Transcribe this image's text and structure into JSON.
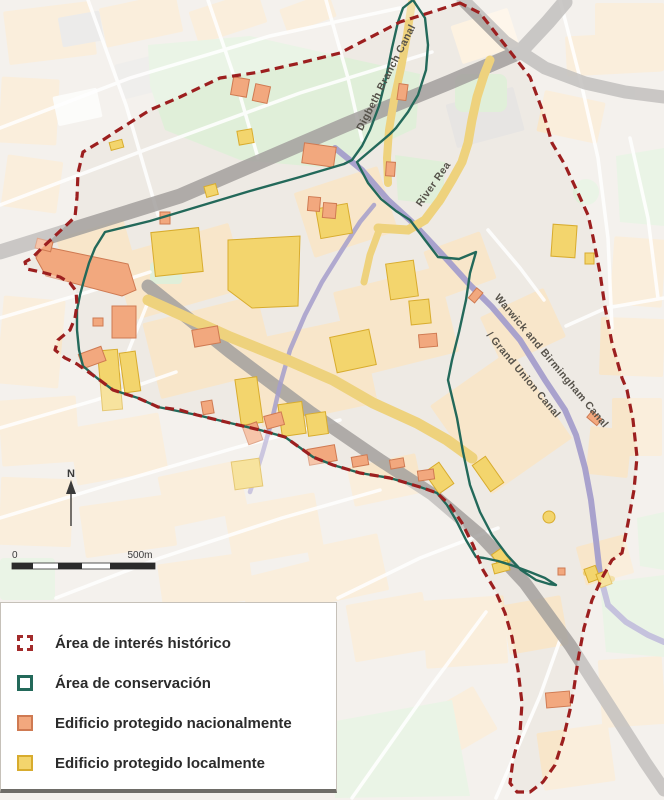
{
  "map": {
    "labels": {
      "digbeth_canal": "Digbeth Branch Canal",
      "river_rea": "River Rea",
      "warwick_canal": "Warwick and Birmingham Canal",
      "grand_union": "/ Grand Union Canal"
    },
    "north_label": "N",
    "scale": {
      "start": "0",
      "end": "500m"
    }
  },
  "legend": {
    "items": [
      {
        "label": "Área de interés histórico",
        "swatch": "dashed-outline",
        "color": "#a32b2b"
      },
      {
        "label": "Área de conservación",
        "swatch": "solid-outline",
        "color": "#23695a"
      },
      {
        "label": "Edificio protegido nacionalmente",
        "swatch": "fill",
        "color": "#f2a87e",
        "border": "#cf7a52"
      },
      {
        "label": "Edificio protegido localmente",
        "swatch": "fill",
        "color": "#f3d56d",
        "border": "#d8ac2e"
      }
    ]
  },
  "colors": {
    "historic_boundary": "#9c1f1f",
    "conservation_boundary": "#23695a",
    "national_building_fill": "#f2a87e",
    "national_building_border": "#cf7a52",
    "local_building_fill": "#f3d56d",
    "local_building_border": "#d8ac2e",
    "railway": "#a3a09e",
    "canal": "#a49ecb",
    "main_road": "#eed27d",
    "green_space": "#e0efd9",
    "block": "#f8e6ca"
  }
}
